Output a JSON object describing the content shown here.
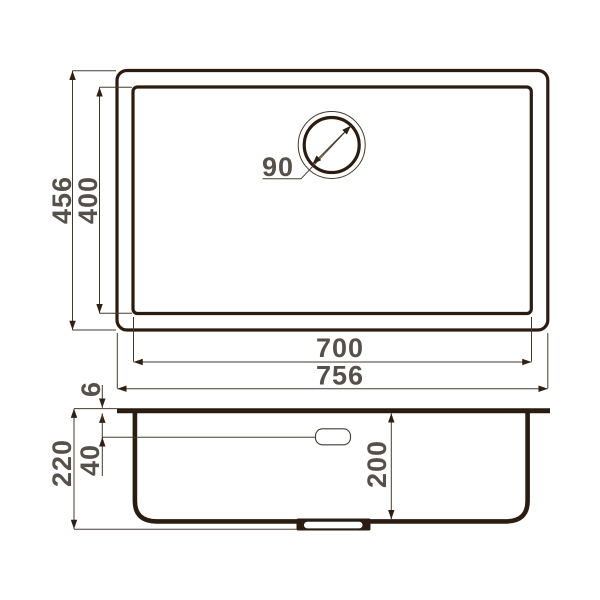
{
  "drawing": {
    "kind": "sink-technical-drawing",
    "colors": {
      "outline": "#2b1c11",
      "dimension_line": "#473a2d",
      "dimension_text": "#56504a",
      "background": "#ffffff"
    },
    "top_view": {
      "overall_height_label": "456",
      "bowl_height_label": "400",
      "drain_diameter_label": "90",
      "bowl_width_label": "700",
      "overall_width_label": "756"
    },
    "side_view": {
      "rim_thickness_label": "6",
      "overflow_offset_label": "40",
      "overall_depth_label": "220",
      "bowl_depth_label": "200"
    }
  }
}
